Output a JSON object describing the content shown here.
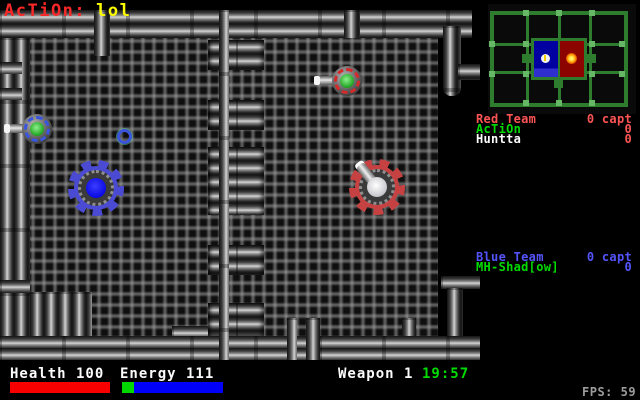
{
  "hud_top": {
    "clan": "AcTiOn:",
    "value": "lol",
    "clan_color": "#f82828",
    "value_color": "#fcfc00"
  },
  "minimap": {
    "wall_color": "#2e7d2e",
    "tick_color": "#66b866",
    "blue_base_color": "#0000a0",
    "red_base_color": "#8c0400",
    "blue_base_marker": "white-flag-marker",
    "red_base_marker": "orange-flame-marker"
  },
  "scoreboard": {
    "red": {
      "team_label": "Red Team",
      "team_score": "0 capt",
      "team_color": "#fc5454",
      "players": [
        {
          "name": "AcTiOn",
          "score": "0",
          "name_color": "#00dc00"
        },
        {
          "name": "Huntta",
          "score": "0",
          "name_color": "#fcfcfc"
        }
      ]
    },
    "blue": {
      "team_label": "Blue Team",
      "team_score": "0 capt",
      "team_color": "#5454fc",
      "players": [
        {
          "name": "MH-Shad[ow]",
          "score": "0",
          "name_color": "#00dc00"
        }
      ]
    }
  },
  "status_bar": {
    "health_label": "Health 100",
    "health_bar_color": "#f80000",
    "energy_label": "Energy 111",
    "energy_bar_colors": [
      "#00d800",
      "#0000f8"
    ],
    "weapon_label": "Weapon 1",
    "timer": "19:57",
    "timer_color": "#00dc00",
    "fps": "FPS: 59",
    "fps_color": "#9c9c9c"
  },
  "sprites": {
    "blue_gear_robot": {
      "gear_color": "#4a4ad2",
      "core_color": "#0a0ae4"
    },
    "red_gear_robot": {
      "gear_color": "#c64242",
      "core_color": "#ffffff",
      "has_cannon": true
    },
    "green_turret_red_marks": {
      "ring_color": "#d42a2a",
      "core_color": "#27a827"
    },
    "green_turret_blue_marks": {
      "ring_color": "#3a56e0",
      "core_color": "#27a827"
    },
    "pickup_ring": {
      "ring_color": "#3c54d8"
    }
  }
}
